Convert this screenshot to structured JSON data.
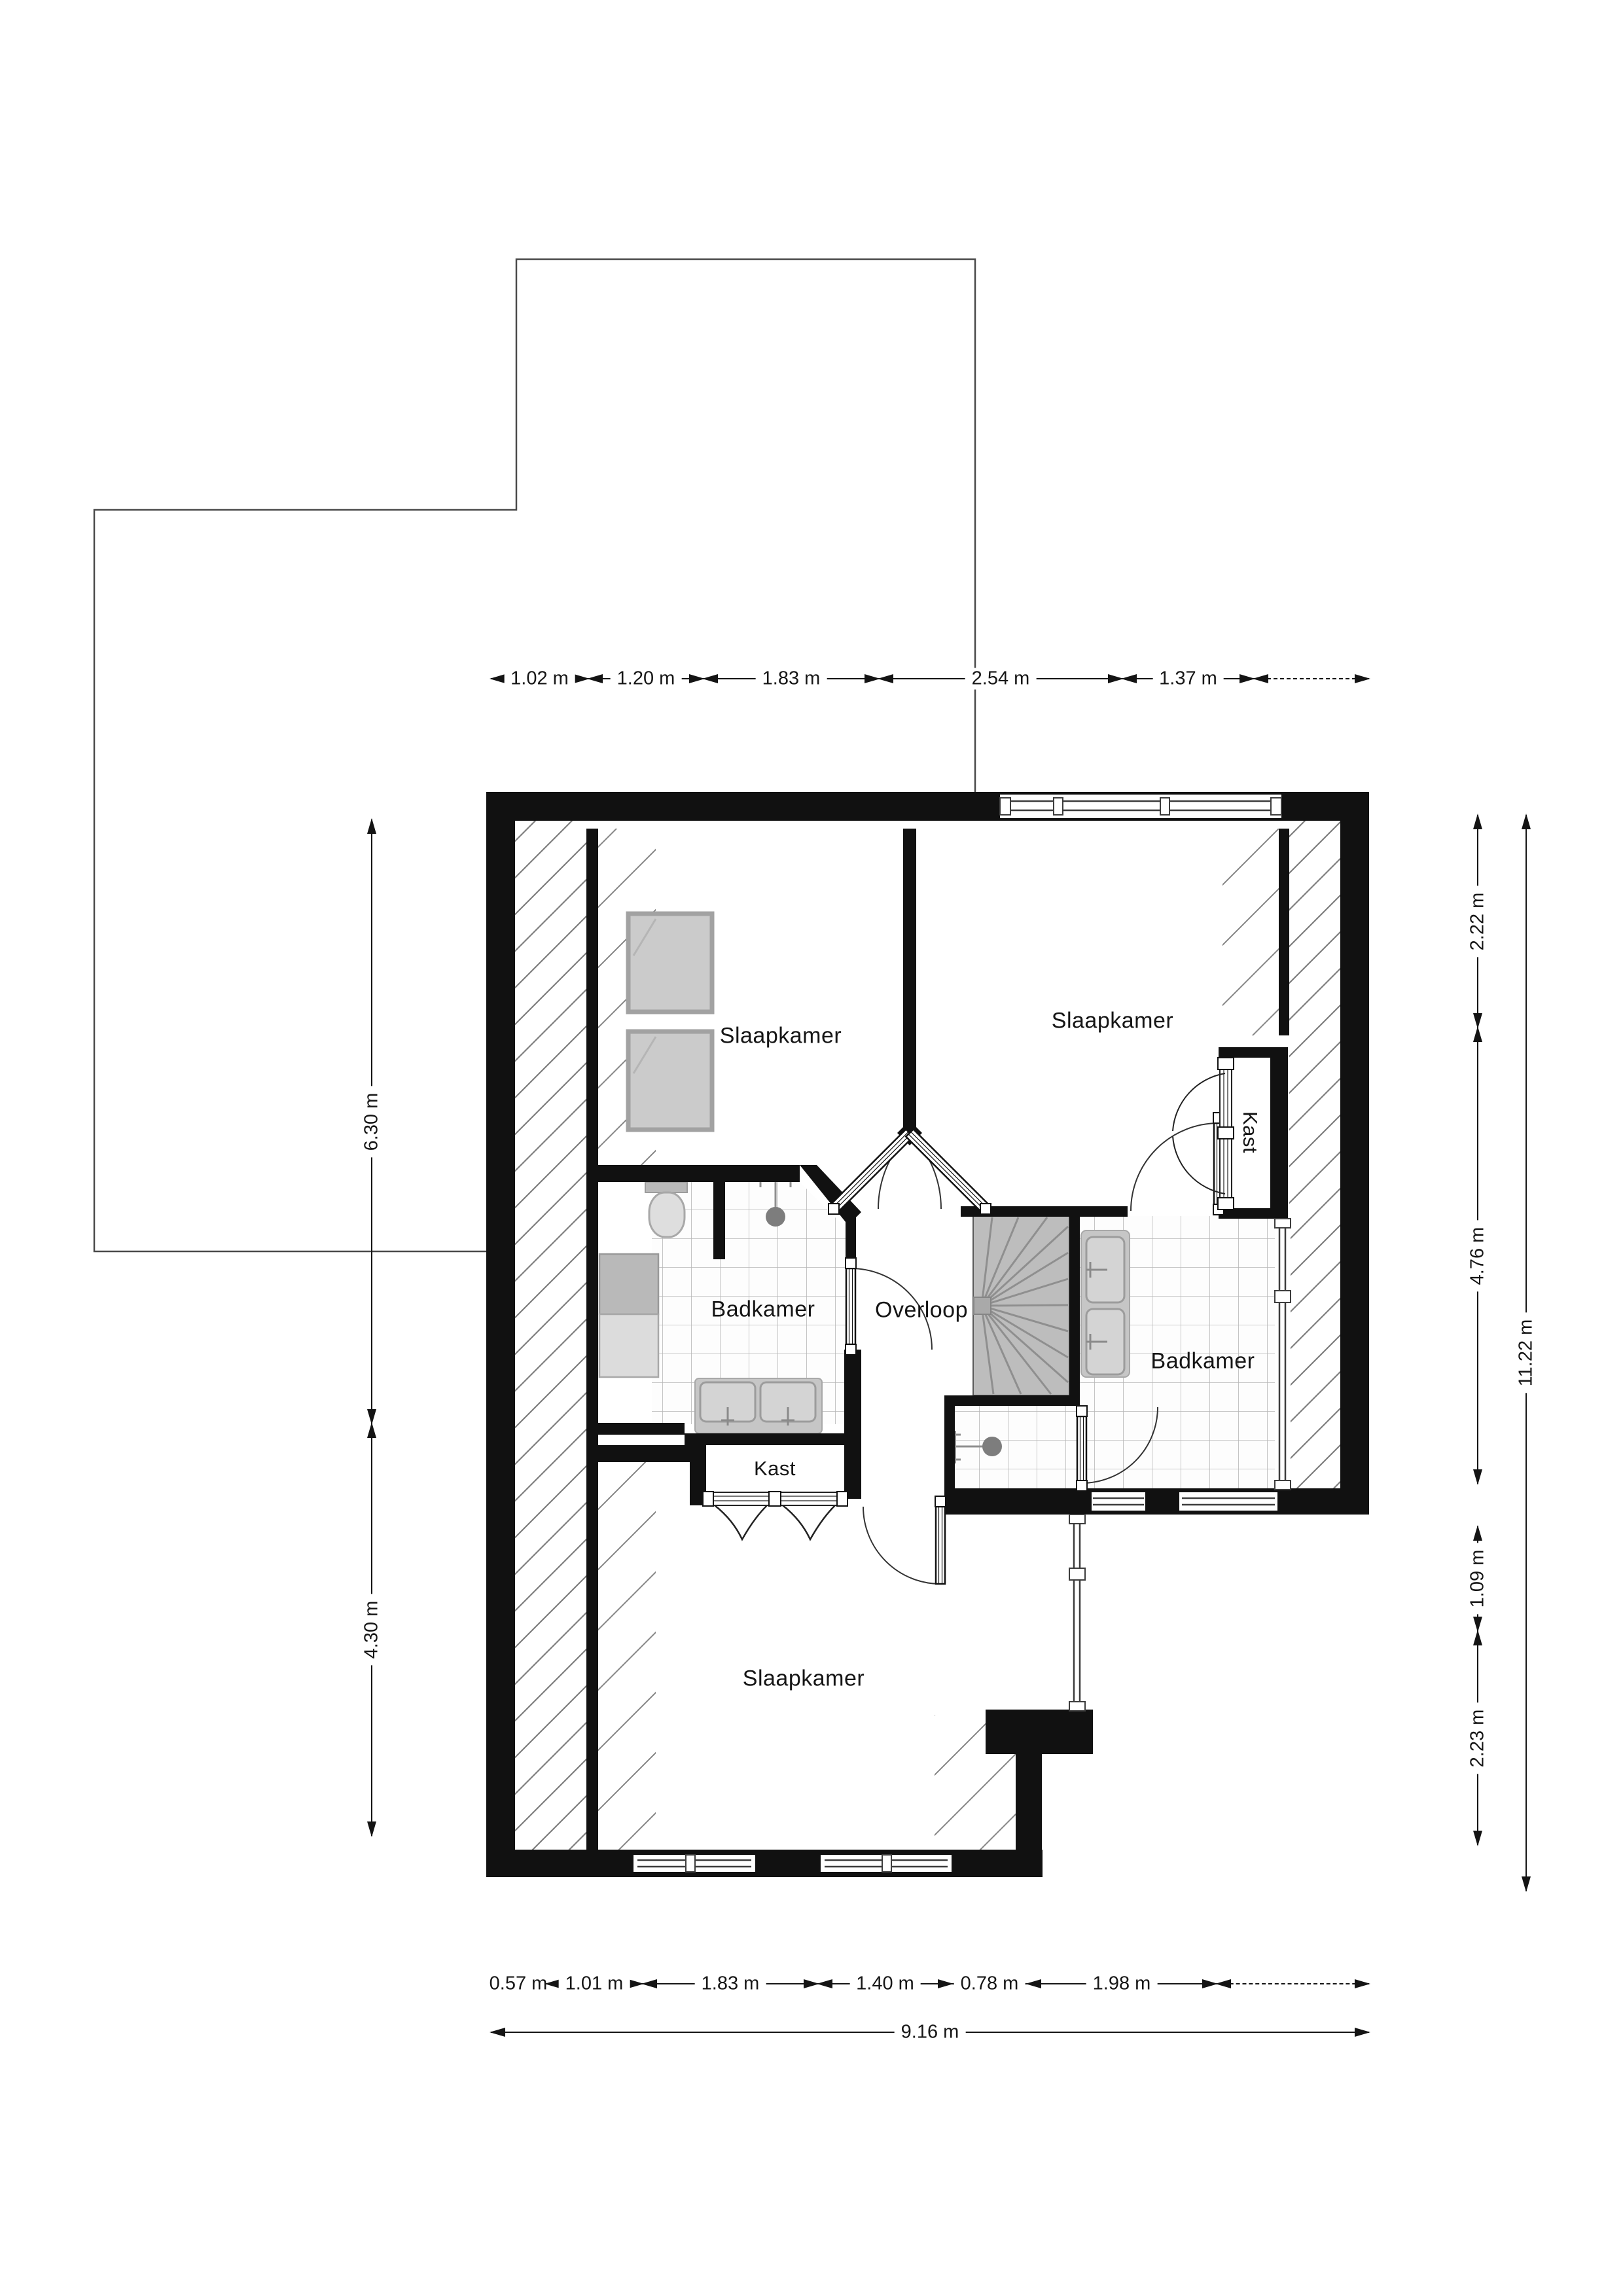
{
  "title": "Verdieping plattegrond (floor plan)",
  "rooms": {
    "slaapkamer_tl": "Slaapkamer",
    "slaapkamer_tr": "Slaapkamer",
    "slaapkamer_b": "Slaapkamer",
    "badkamer_l": "Badkamer",
    "badkamer_r": "Badkamer",
    "overloop": "Overloop",
    "kast_r": "Kast",
    "kast_b": "Kast"
  },
  "dims": {
    "top": [
      "1.02 m",
      "1.20 m",
      "1.83 m",
      "2.54 m",
      "1.37 m"
    ],
    "bottom": [
      "0.57 m",
      "1.01 m",
      "1.83 m",
      "1.40 m",
      "0.78 m",
      "1.98 m"
    ],
    "bottom_total": "9.16 m",
    "left": [
      "6.30 m",
      "4.30 m"
    ],
    "right": [
      "2.22 m",
      "4.76 m",
      "1.09 m",
      "2.23 m"
    ],
    "right_total": "11.22 m"
  },
  "icons": {
    "fixtures": [
      "bed-icon",
      "toilet-icon",
      "shower-icon",
      "washer-dryer-icon",
      "double-sink-icon",
      "double-basin-icon",
      "spiral-stairs-icon",
      "folding-closet-door-icon",
      "door-swing-icon",
      "window-icon"
    ]
  },
  "colors": {
    "wall": "#111111",
    "hatch": "#7e7e7e",
    "tile_line": "#b7b7b7",
    "fixture_fill": "#cccccc",
    "fixture_edge": "#9c9c9c",
    "stairs_fill": "#bdbdbd",
    "stairs_line": "#8f8f8f",
    "outline_below": "#4a4a4a",
    "text": "#151515"
  }
}
